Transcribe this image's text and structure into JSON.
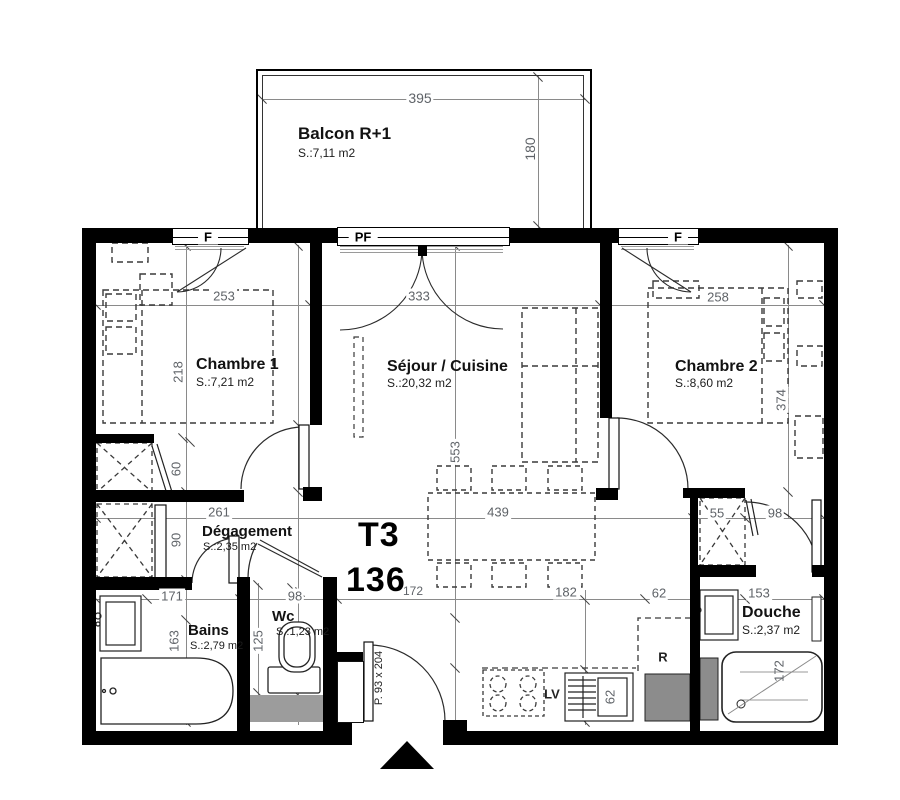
{
  "plan": {
    "unit_type": "T3",
    "unit_number": "136"
  },
  "rooms": {
    "balcon": {
      "name": "Balcon R+1",
      "area": "S.:7,11 m2"
    },
    "chambre1": {
      "name": "Chambre 1",
      "area": "S.:7,21 m2"
    },
    "sejour": {
      "name": "Séjour / Cuisine",
      "area": "S.:20,32 m2"
    },
    "chambre2": {
      "name": "Chambre 2",
      "area": "S.:8,60 m2"
    },
    "degagement": {
      "name": "Dégagement",
      "area": "S.:2,35 m2"
    },
    "bains": {
      "name": "Bains",
      "area": "S.:2,79 m2"
    },
    "wc": {
      "name": "Wc",
      "area": "S.:1,23 m2"
    },
    "douche": {
      "name": "Douche",
      "area": "S.:2,37 m2"
    }
  },
  "windows": {
    "f1": "F",
    "pf": "PF",
    "f2": "F"
  },
  "appliances": {
    "dishwasher": "LV",
    "fridge": "R"
  },
  "entrance": {
    "door_size": "P. 93 x 204"
  },
  "dimensions": {
    "balcon_width": "395",
    "balcon_depth": "180",
    "chambre1_width": "253",
    "chambre1_depth": "218",
    "sejour_width": "333",
    "sejour_depth": "553",
    "sejour_inner_width": "439",
    "chambre2_width": "258",
    "chambre2_depth": "374",
    "closet_upper_depth": "60",
    "closet_lower_depth": "90",
    "degagement_width": "261",
    "bains_width": "171",
    "bains_depth": "163",
    "wc_width": "98",
    "wc_depth": "125",
    "hall_width": "172",
    "kitchen_width": "182",
    "kitchen_sink_depth": "62",
    "fridge_width": "62",
    "closet2_width": "55",
    "douche_entry_width": "98",
    "douche_width": "153",
    "douche_diag": "172"
  },
  "colors": {
    "wall": "#000000",
    "dim_text": "#5f6368",
    "appliance_fill": "#8c8c8c",
    "floor_gray": "#9c9c9c"
  }
}
